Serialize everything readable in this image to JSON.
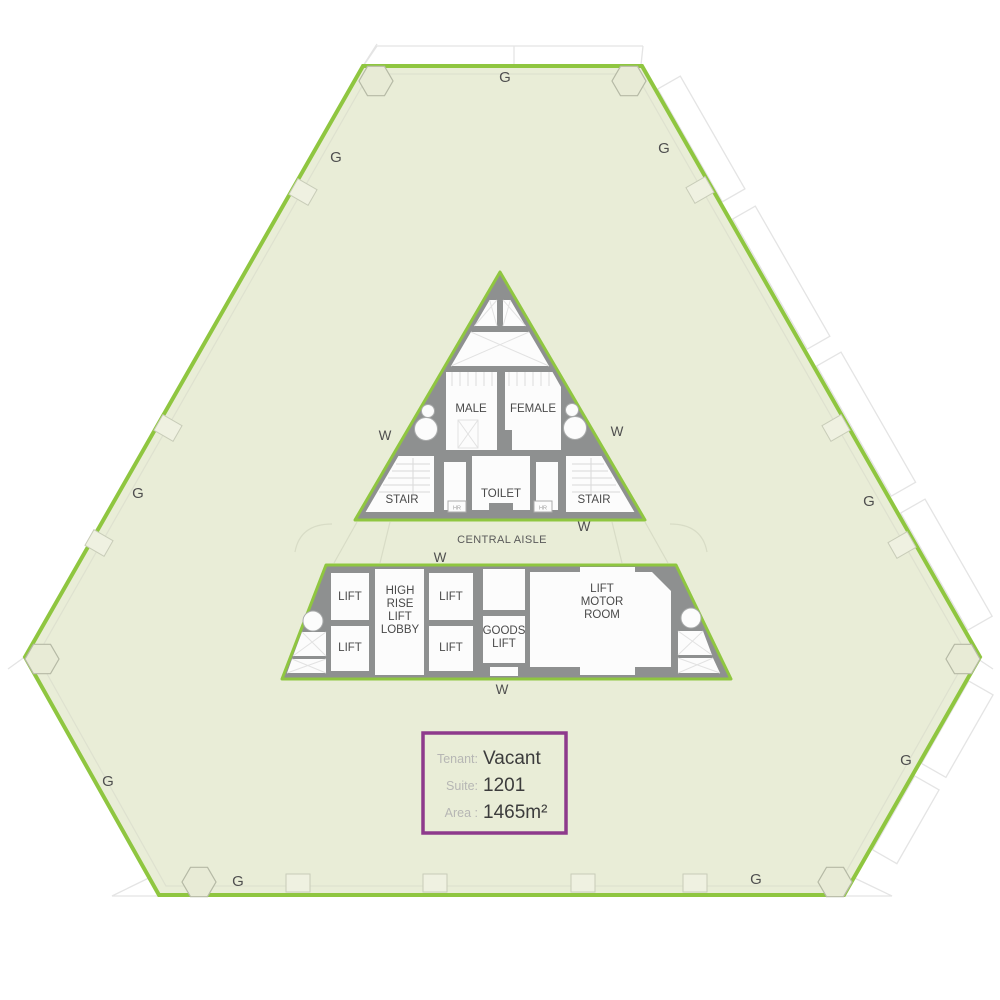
{
  "colors": {
    "boundary_green": "#8FC640",
    "floor_fill": "#E9EDD7",
    "core_wall_gray": "#8E9090",
    "info_border_purple": "#8E3A8C",
    "info_label_gray": "#B6B6B4",
    "info_value_dark": "#3C3C3C"
  },
  "plan": {
    "perimeter_label": "G",
    "window_label": "W",
    "central_aisle_label": "CENTRAL AISLE",
    "upper_core": {
      "male": "MALE",
      "female": "FEMALE",
      "toilet": "TOILET",
      "stair": "STAIR",
      "hose_reel": "HR"
    },
    "lower_core": {
      "lift": "LIFT",
      "high_rise_lobby_lines": [
        "HIGH",
        "RISE",
        "LIFT",
        "LOBBY"
      ],
      "goods_lift_lines": [
        "GOODS",
        "LIFT"
      ],
      "lift_motor_room_lines": [
        "LIFT",
        "MOTOR",
        "ROOM"
      ]
    }
  },
  "info_box": {
    "tenant_label": "Tenant:",
    "tenant_value": "Vacant",
    "suite_label": "Suite:",
    "suite_value": "1201",
    "area_label": "Area :",
    "area_value": "1465m²"
  }
}
